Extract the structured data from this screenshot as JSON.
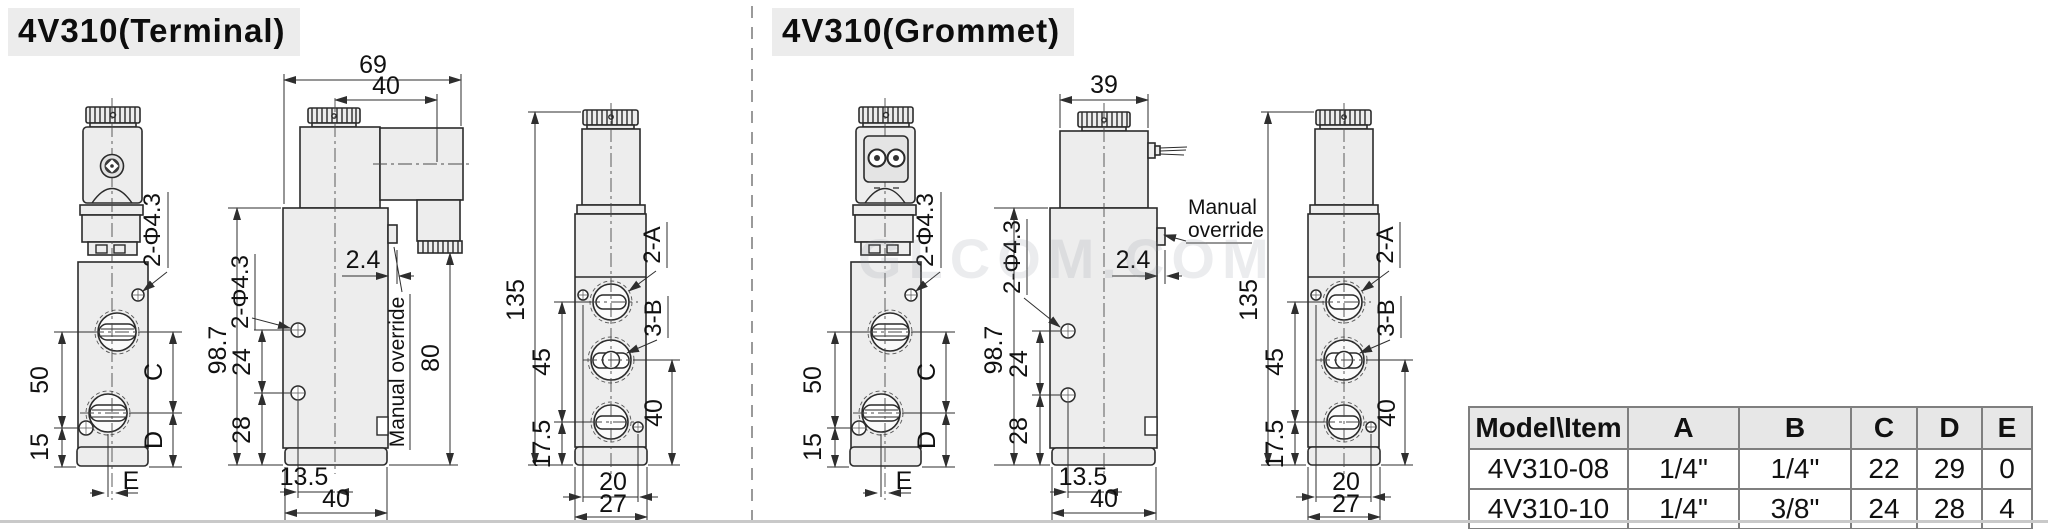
{
  "titles": {
    "terminal": "4V310(Terminal)",
    "grommet": "4V310(Grommet)"
  },
  "watermark": "GLCOM.COM",
  "terminal": {
    "front": {
      "hole_label": "2-Φ4.3",
      "d50": "50",
      "d15": "15",
      "dC": "C",
      "dD": "D",
      "dE": "E"
    },
    "side": {
      "d69": "69",
      "d40top": "40",
      "hole_label": "2-Φ4.3",
      "d987": "98.7",
      "d24": "24",
      "d28": "28",
      "d2_4": "2.4",
      "manual": "Manual override",
      "d80": "80",
      "d13_5": "13.5",
      "d40": "40"
    },
    "right": {
      "d135": "135",
      "d45": "45",
      "d17_5": "17.5",
      "d40": "40",
      "d20": "20",
      "d27": "27",
      "a": "2-A",
      "b": "3-B"
    }
  },
  "grommet": {
    "front": {
      "hole_label": "2-Φ4.3",
      "d50": "50",
      "d15": "15",
      "dC": "C",
      "dD": "D",
      "dE": "E"
    },
    "side": {
      "d39": "39",
      "hole_label": "2-Φ4.3",
      "d987": "98.7",
      "d24": "24",
      "d28": "28",
      "d2_4": "2.4",
      "manual1": "Manual",
      "manual2": "override",
      "d13_5": "13.5",
      "d40": "40"
    },
    "right": {
      "d135": "135",
      "d45": "45",
      "d17_5": "17.5",
      "d40": "40",
      "d20": "20",
      "d27": "27",
      "a": "2-A",
      "b": "3-B"
    }
  },
  "table": {
    "headers": [
      "Model\\Item",
      "A",
      "B",
      "C",
      "D",
      "E"
    ],
    "rows": [
      [
        "4V310-08",
        "1/4\"",
        "1/4\"",
        "22",
        "29",
        "0"
      ],
      [
        "4V310-10",
        "1/4\"",
        "3/8\"",
        "24",
        "28",
        "4"
      ]
    ]
  },
  "colors": {
    "line": "#2b2b2b",
    "body_fill": "#ededed",
    "table_border": "#7f7f7f",
    "header_bg": "#e7e7e7"
  }
}
